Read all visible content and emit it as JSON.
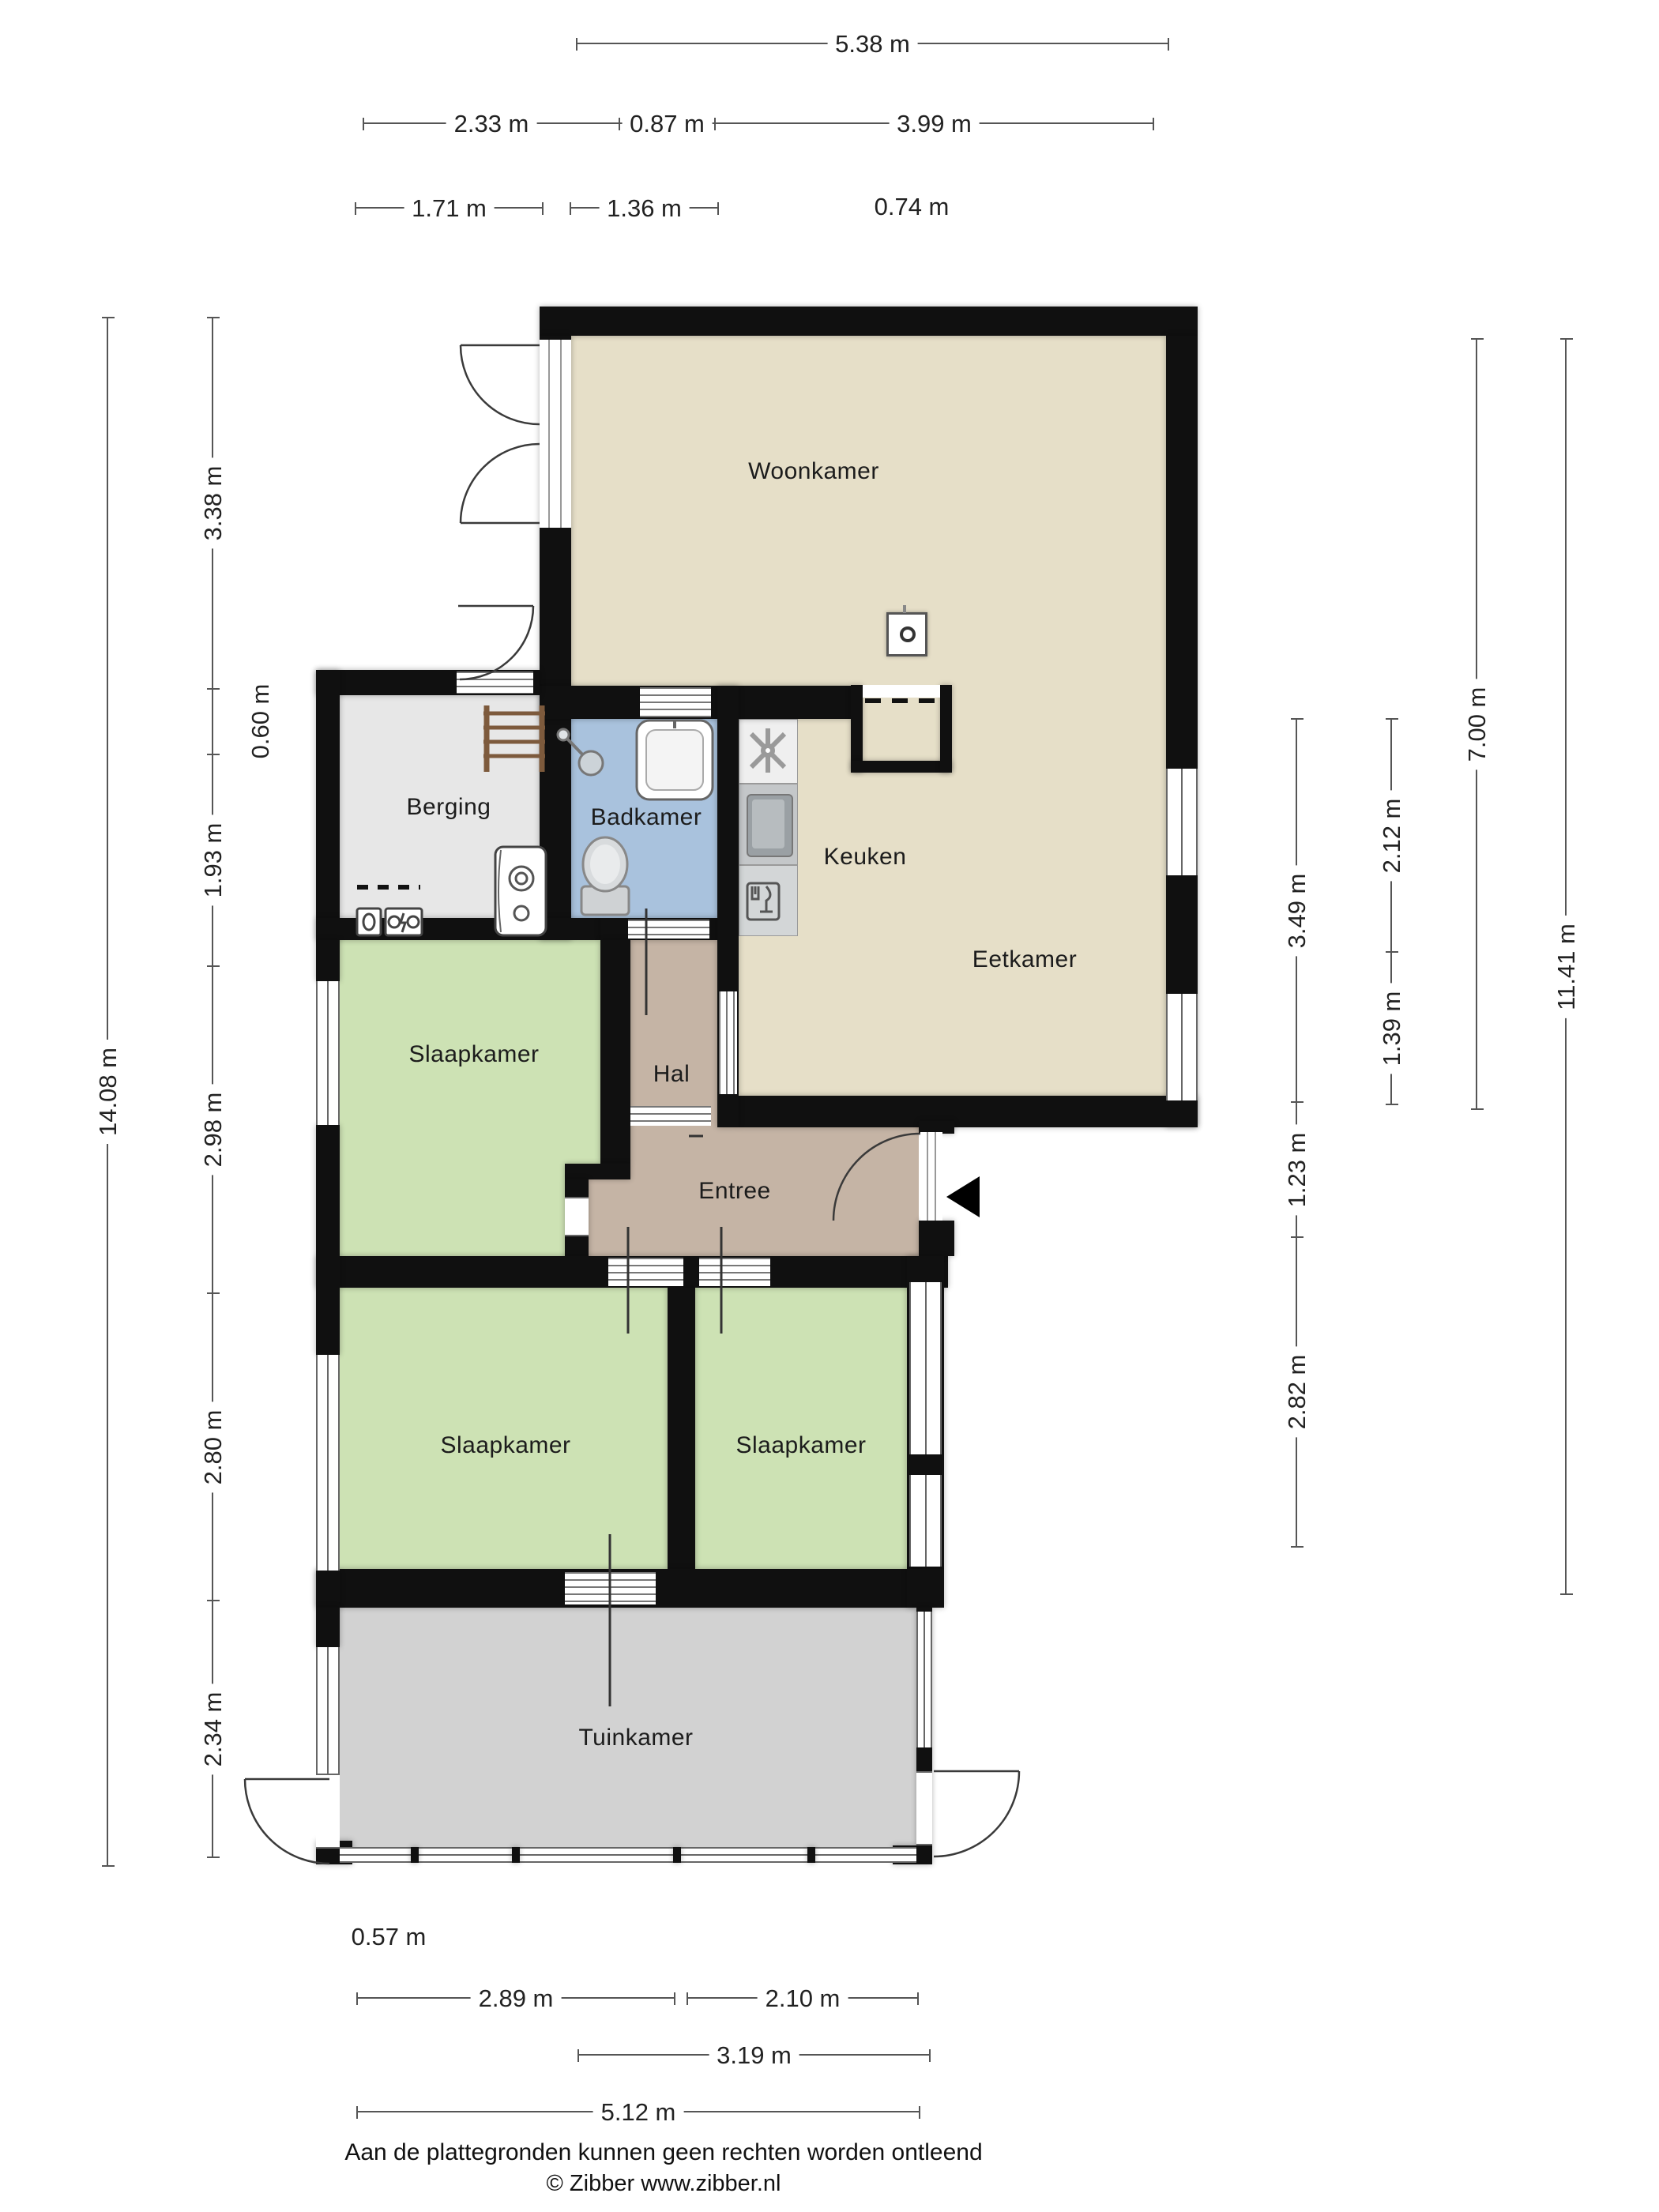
{
  "rooms": {
    "woonkamer": "Woonkamer",
    "keuken": "Keuken",
    "eetkamer": "Eetkamer",
    "badkamer": "Badkamer",
    "berging": "Berging",
    "hal": "Hal",
    "entree": "Entree",
    "slaapkamer1": "Slaapkamer",
    "slaapkamer2": "Slaapkamer",
    "slaapkamer3": "Slaapkamer",
    "tuinkamer": "Tuinkamer"
  },
  "dims": {
    "top": [
      "5.38 m",
      "2.33 m",
      "0.87 m",
      "3.99 m",
      "1.71 m",
      "1.36 m",
      "0.74 m"
    ],
    "left": [
      "14.08 m",
      "3.38 m",
      "0.60 m",
      "1.93 m",
      "2.98 m",
      "2.80 m",
      "2.34 m"
    ],
    "right": [
      "3.49 m",
      "1.23 m",
      "2.82 m",
      "2.12 m",
      "1.39 m",
      "7.00 m",
      "11.41 m"
    ],
    "bottom": [
      "0.57 m",
      "2.89 m",
      "2.10 m",
      "3.19 m",
      "5.12 m"
    ]
  },
  "footer": {
    "disclaimer": "Aan de plattegronden kunnen geen rechten worden ontleend",
    "copyright": "© Zibber www.zibber.nl"
  },
  "colors": {
    "wall": "#101010",
    "floor_living": "#e6dfc8",
    "floor_bath": "#a9c2dd",
    "floor_storage": "#e7e7e7",
    "floor_hall": "#c5b4a5",
    "floor_bedroom": "#cde2b4",
    "floor_garden": "#d2d2d2"
  }
}
